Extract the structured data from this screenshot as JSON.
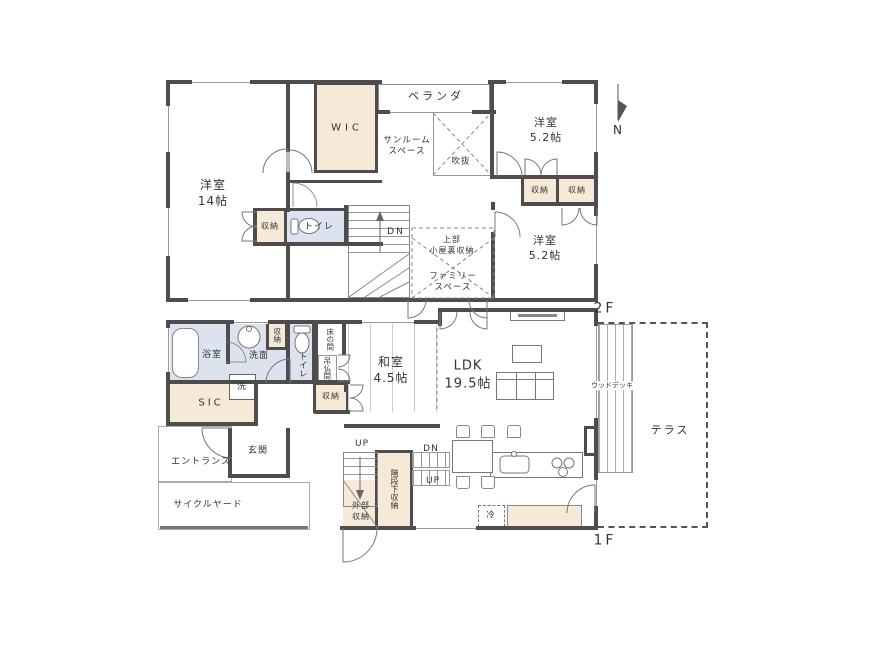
{
  "compass": {
    "north": "N"
  },
  "colors": {
    "wall": "#4d4d4d",
    "storage_fill": "#f6e9d7",
    "wet_fill": "#dde3ee",
    "line": "#999999"
  },
  "floor2": {
    "label": "2F",
    "rooms": {
      "yoshitsu14": "洋室\n14帖",
      "wic": "WIC",
      "veranda": "ベランダ",
      "sunroom": "サンルーム\nスペース",
      "void": "吹抜",
      "yoshitsu52_top": "洋室\n5.2帖",
      "closet_a": "収納",
      "closet_b": "収納",
      "yoshitsu52_bottom": "洋室\n5.2帖",
      "attic_storage": "上部\n小屋裏収納",
      "family_space": "ファミリー\nスペース",
      "hall_closet": "収納",
      "toilet": "トイレ",
      "down": "DN"
    }
  },
  "floor1": {
    "label": "1F",
    "rooms": {
      "bath": "浴室",
      "washroom": "洗面",
      "laundry": "洗",
      "wash_closet": "収納",
      "toilet": "トイレ",
      "tokonoma": "床の間",
      "butsuma": "吊仏間",
      "washitsu_closet": "収納",
      "sic": "SIC",
      "entrance": "エントランス",
      "genkan": "玄関",
      "cycle_yard": "サイクルヤード",
      "washitsu": "和室\n4.5帖",
      "ldk": "LDK\n19.5帖",
      "up_a": "UP",
      "down": "DN",
      "up_b": "UP",
      "under_stair": "階段下収納",
      "external_storage": "外部\n収納",
      "fridge": "冷",
      "wood_deck": "ウッドデッキ",
      "terrace": "テラス"
    }
  }
}
